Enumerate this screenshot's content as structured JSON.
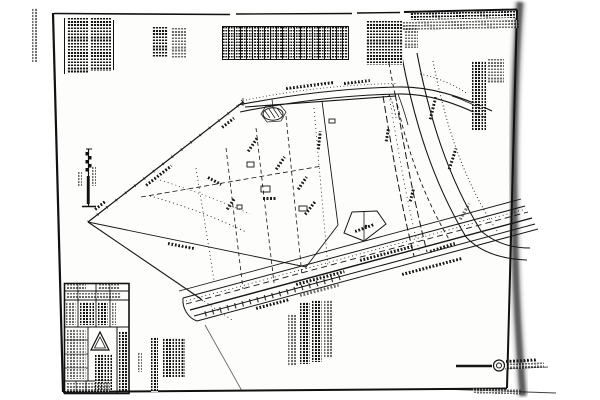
{
  "document": {
    "kind": "scanned-survey-plat-sheet",
    "description": "Black-and-white photocopied land survey / subdivision plat drawing; all annotation text is below legibility at scan resolution",
    "illegible_text": true,
    "colors": {
      "background": "#ffffff",
      "paper": "#fdfdfb",
      "ink": "#141414",
      "page_edge_shadow": "#474747"
    }
  },
  "tooltips": {
    "sheet": "Scanned plat sheet with skewed border",
    "margin_note": "Handwritten recording annotation in left margin (illegible)",
    "notes_block": "Typed surveyor notes, two columns (illegible fine print)",
    "side_notes": "Additional note columns (illegible)",
    "curve_table": "Curve / line data table with many narrow columns (illegible)",
    "dedication_block": "Dedication / certification paragraph (illegible)",
    "header_line": "Recording header text along top border (illegible)",
    "legend_column": "Rotated legend and notes column (illegible)",
    "scale_symbol": "Vertical graphic bar scale with alternating black blocks",
    "plat_drawing": "Plat linework: lot boundaries, easements, pond, structures",
    "street_top": "Street right-of-way at top of tract (label illegible)",
    "right_road": "Curving road / channel on east side",
    "highway": "Multi-lane divided highway crossing lower right",
    "legend_rotated": "Rotated schedule text block below drawing (illegible)",
    "sheet_title_vertical": "Vertical sheet title text (illegible)",
    "title_block": "Title block grid with engineering firm triangle logo (illegible)",
    "stamp_strip": "Firm seal / logo strip at lower right",
    "annotation": "Bearing-and-distance annotation squiggle (illegible)"
  }
}
